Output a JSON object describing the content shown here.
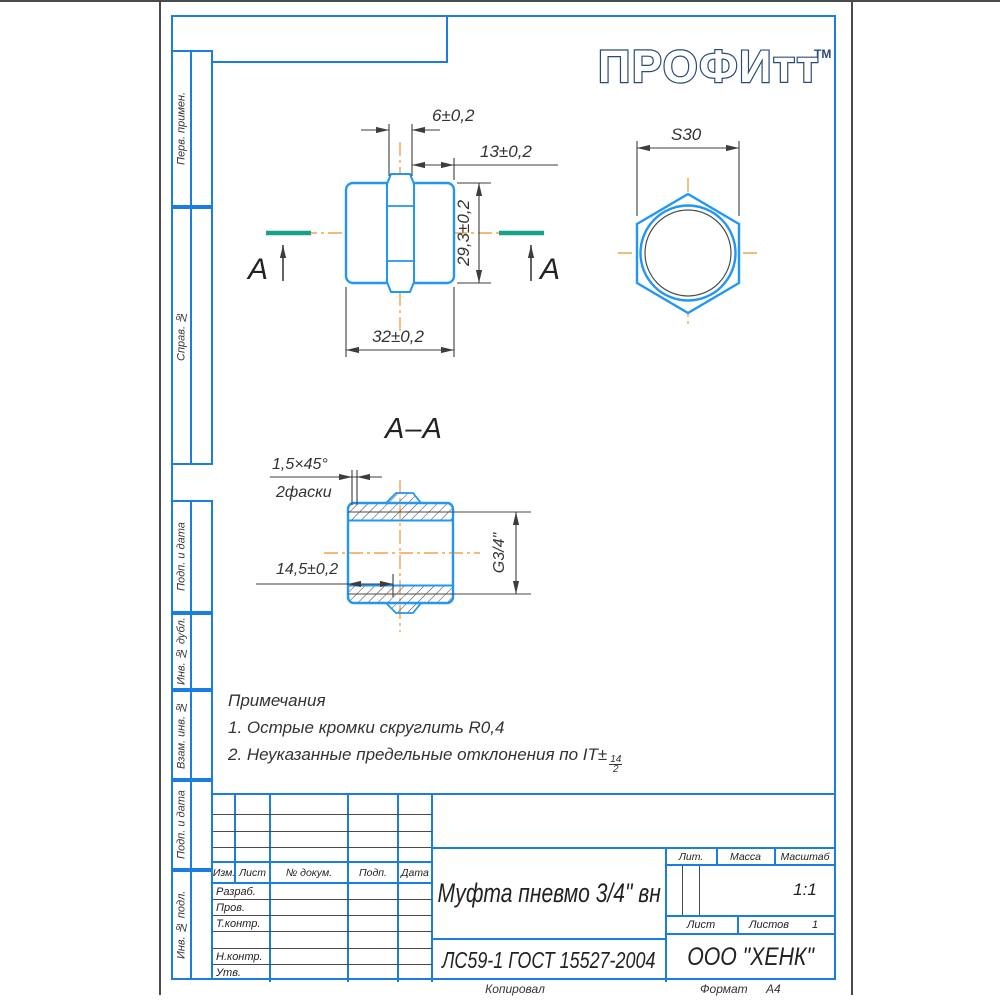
{
  "logo": {
    "text": "ПРОФИтт",
    "tm": "ТМ"
  },
  "sidebar": {
    "cells": [
      "Перв. примен.",
      "Справ. №",
      "Подп. и дата",
      "Инв. № дубл.",
      "Взам. инв. №",
      "Подп. и дата",
      "Инв. № подл."
    ]
  },
  "drawing": {
    "front_view": {
      "dim_hex_width": "6±0,2",
      "dim_thread_len": "13±0,2",
      "dim_height": "29,3±0,2",
      "dim_length": "32±0,2",
      "section_mark_left": "А",
      "section_mark_right": "А"
    },
    "hex_view": {
      "dim_across_flats": "S30"
    },
    "section_view": {
      "title": "А–А",
      "chamfer": "1,5×45°",
      "chamfer_count": "2фаски",
      "dim_thread_depth": "14,5±0,2",
      "dim_thread": "G3/4\""
    }
  },
  "notes": {
    "heading": "Примечания",
    "note1": "1. Острые кромки скруглить R0,4",
    "note2": "2. Неуказанные предельные отклонения по IT±",
    "note2_frac_num": "14",
    "note2_frac_den": "2"
  },
  "title_block": {
    "change_header": [
      "Изм.",
      "Лист",
      "№ докум.",
      "Подп.",
      "Дата"
    ],
    "signature_rows": [
      "Разраб.",
      "Пров.",
      "Т.контр.",
      "Н.контр.",
      "Утв."
    ],
    "part_name": "Муфта пневмо 3/4\" вн",
    "material": "ЛС59-1 ГОСТ 15527-2004",
    "lit_label": "Лит.",
    "mass_label": "Масса",
    "scale_label": "Масштаб",
    "scale_value": "1:1",
    "sheet_label": "Лист",
    "sheets_label": "Листов",
    "sheets_value": "1",
    "company": "ООО \"ХЕНК\""
  },
  "footer": {
    "copied": "Копировал",
    "format_label": "Формат",
    "format_value": "А4"
  },
  "colors": {
    "frame_blue": "#1b7de0",
    "part_blue": "#2196f3",
    "centerline_orange": "#f2a24e",
    "section_green": "#17a189",
    "line_dark": "#3d3d3d",
    "logo_navy": "#2a4a78"
  }
}
